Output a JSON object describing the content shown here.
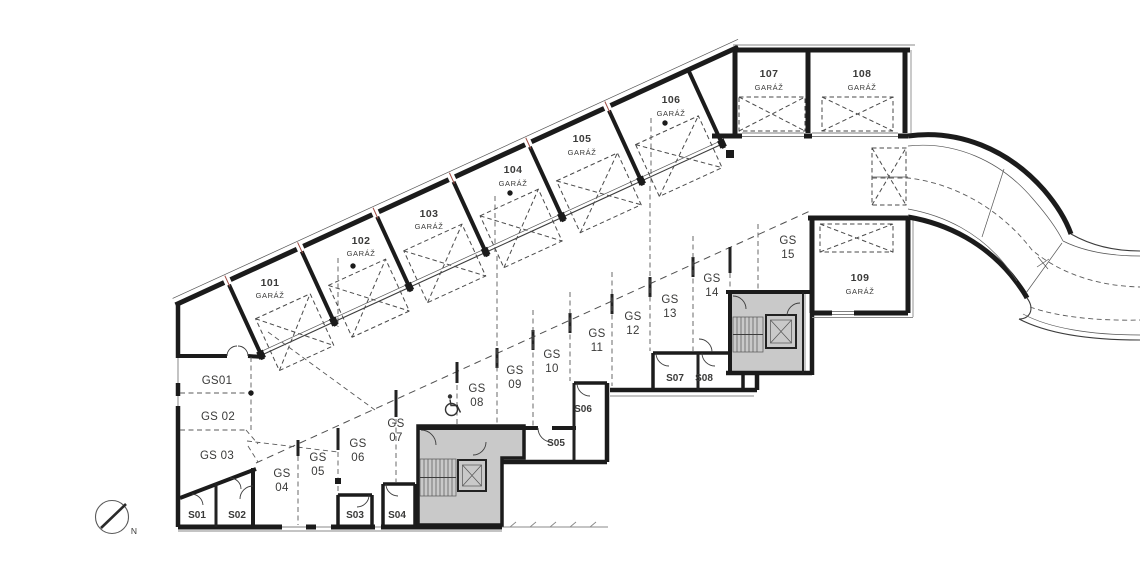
{
  "drawing": {
    "type": "floor-plan",
    "language": "cs",
    "garages": [
      {
        "number": "101",
        "type": "GARÁŽ"
      },
      {
        "number": "102",
        "type": "GARÁŽ"
      },
      {
        "number": "103",
        "type": "GARÁŽ"
      },
      {
        "number": "104",
        "type": "GARÁŽ"
      },
      {
        "number": "105",
        "type": "GARÁŽ"
      },
      {
        "number": "106",
        "type": "GARÁŽ"
      },
      {
        "number": "107",
        "type": "GARÁŽ"
      },
      {
        "number": "108",
        "type": "GARÁŽ"
      },
      {
        "number": "109",
        "type": "GARÁŽ"
      }
    ],
    "parking": [
      {
        "label": "GS01"
      },
      {
        "label": "GS 02"
      },
      {
        "label": "GS 03"
      },
      {
        "line1": "GS",
        "line2": "04"
      },
      {
        "line1": "GS",
        "line2": "05"
      },
      {
        "line1": "GS",
        "line2": "06"
      },
      {
        "line1": "GS",
        "line2": "07"
      },
      {
        "line1": "GS",
        "line2": "08"
      },
      {
        "line1": "GS",
        "line2": "09"
      },
      {
        "line1": "GS",
        "line2": "10"
      },
      {
        "line1": "GS",
        "line2": "11"
      },
      {
        "line1": "GS",
        "line2": "12"
      },
      {
        "line1": "GS",
        "line2": "13"
      },
      {
        "line1": "GS",
        "line2": "14"
      },
      {
        "line1": "GS",
        "line2": "15"
      }
    ],
    "storage": [
      {
        "label": "S01"
      },
      {
        "label": "S02"
      },
      {
        "label": "S03"
      },
      {
        "label": "S04"
      },
      {
        "label": "S05"
      },
      {
        "label": "S06"
      },
      {
        "label": "S07"
      },
      {
        "label": "S08"
      }
    ],
    "compass": {
      "north_label": "N"
    },
    "colors": {
      "wall": "#1b1b1b",
      "core_fill": "#c9c9c9",
      "dashed": "#5a5a5a",
      "text": "#3a3a39",
      "junction_tick": "#9e4b43"
    }
  }
}
